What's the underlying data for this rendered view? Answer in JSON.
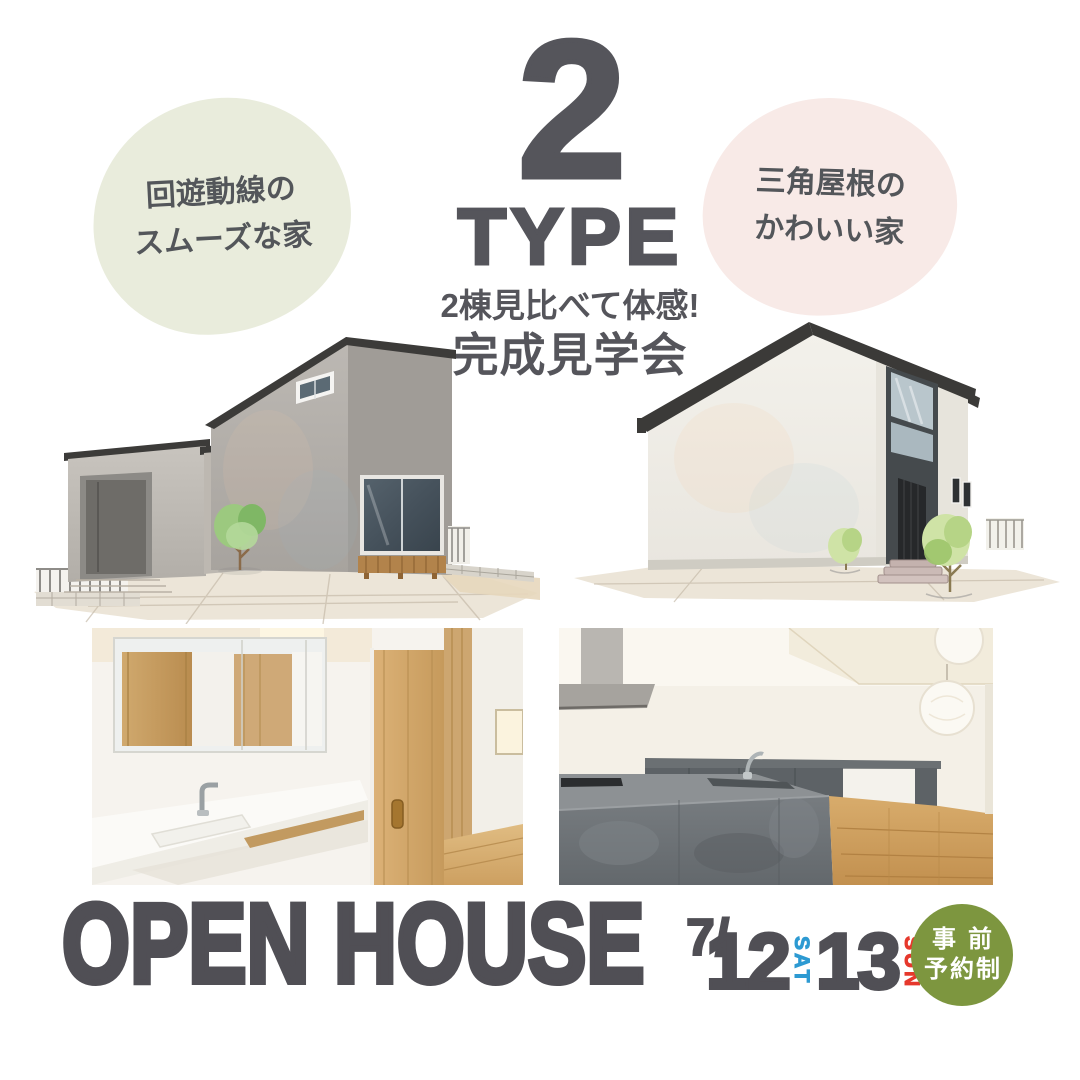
{
  "page": {
    "background": "#ffffff"
  },
  "headline": {
    "number": "2",
    "word": "TYPE",
    "subtitle": "2棟見比べて体感!",
    "title": "完成見学会",
    "color": "#55555b"
  },
  "labels": {
    "left": {
      "line1": "回遊動線の",
      "line2": "スムーズな家",
      "bg": "#e9ecdc",
      "color": "#53565a"
    },
    "right": {
      "line1": "三角屋根の",
      "line2": "かわいい家",
      "bg": "#f8eae7",
      "color": "#53565a"
    }
  },
  "footer": {
    "title": "OPEN HOUSE",
    "month": "7/",
    "day1": {
      "number": "12",
      "weekday": "SAT",
      "weekday_color": "#2d9ad2"
    },
    "day2": {
      "number": "13",
      "weekday": "SUN",
      "weekday_color": "#e6382c"
    },
    "color": "#504f55",
    "reservation": {
      "line1": "事前",
      "line2": "予約制",
      "bg": "#7d963f",
      "color": "#ffffff"
    }
  }
}
